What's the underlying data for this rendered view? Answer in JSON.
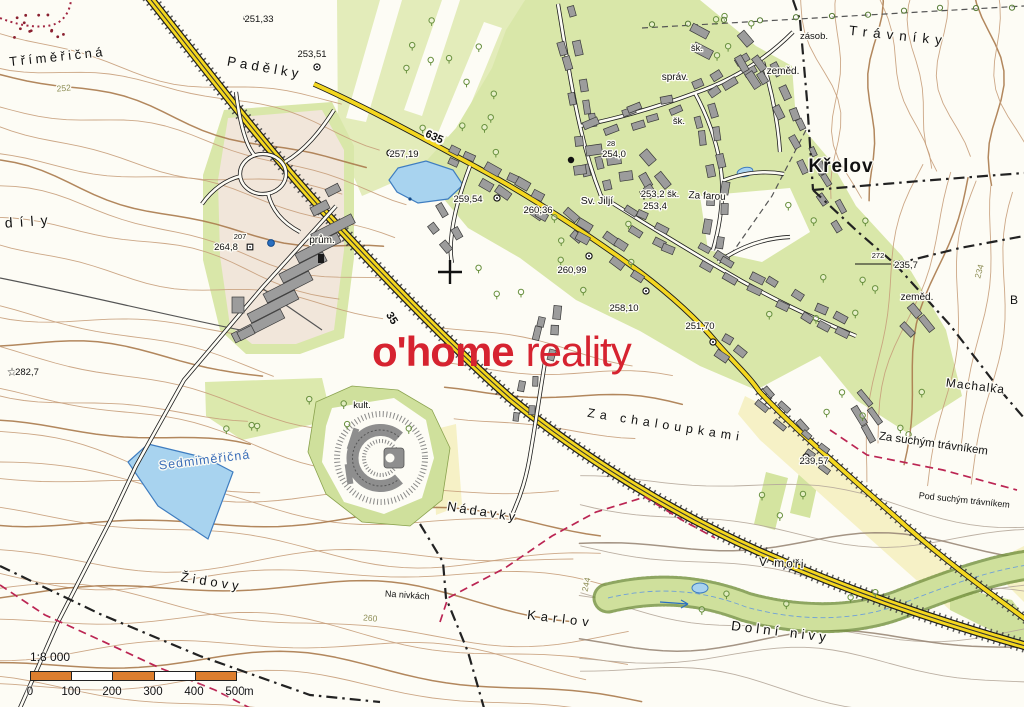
{
  "brand": {
    "part1": "o'home",
    "part2": "reality",
    "color": "#d62330"
  },
  "scale_bar": {
    "ratio": "1:8 000",
    "tick_labels": [
      "0",
      "100",
      "200",
      "300",
      "400",
      "500"
    ],
    "unit": "m",
    "bar_color": "#dd7e2e",
    "segment_count": 5
  },
  "road_labels": [
    {
      "text": "635",
      "x": 433,
      "y": 140,
      "rot": 24
    },
    {
      "text": "35",
      "x": 389,
      "y": 320,
      "rot": 58
    }
  ],
  "contour_labels": [
    {
      "text": "252",
      "x": 64,
      "y": 91,
      "rot": -5
    },
    {
      "text": "260",
      "x": 370,
      "y": 621,
      "rot": 5
    },
    {
      "text": "244",
      "x": 589,
      "y": 585,
      "rot": -78
    },
    {
      "text": "234",
      "x": 982,
      "y": 272,
      "rot": -75
    }
  ],
  "place_labels": [
    {
      "text": "Tříměřičná",
      "x": 58,
      "y": 61,
      "size": 13,
      "rot": -6,
      "ls": 3.5
    },
    {
      "text": "Padělky",
      "x": 264,
      "y": 72,
      "size": 13.5,
      "rot": 10,
      "ls": 4
    },
    {
      "text": "díly",
      "x": 30,
      "y": 226,
      "size": 14,
      "rot": -4,
      "ls": 7
    },
    {
      "text": "Trávníky",
      "x": 898,
      "y": 40,
      "size": 13.5,
      "rot": 6,
      "ls": 6
    },
    {
      "text": "Křelov",
      "x": 841,
      "y": 172,
      "size": 19,
      "rot": 0,
      "ls": 1,
      "bold": true
    },
    {
      "text": "zásob.",
      "x": 814,
      "y": 39,
      "size": 9.5
    },
    {
      "text": "zeměd.",
      "x": 783,
      "y": 74,
      "size": 10
    },
    {
      "text": "zeměd.",
      "x": 917,
      "y": 300,
      "size": 10
    },
    {
      "text": "šk.",
      "x": 697,
      "y": 51,
      "size": 9.5
    },
    {
      "text": "šk.",
      "x": 679,
      "y": 124,
      "size": 9.5
    },
    {
      "text": "správ.",
      "x": 675,
      "y": 80,
      "size": 10
    },
    {
      "text": "Sv. Jiljí",
      "x": 597,
      "y": 204,
      "size": 10.5
    },
    {
      "text": "Za farou",
      "x": 707,
      "y": 199,
      "size": 10,
      "rot": 3
    },
    {
      "text": "prům.",
      "x": 322,
      "y": 243,
      "size": 10
    },
    {
      "text": "kult.",
      "x": 362,
      "y": 408,
      "size": 9.5
    },
    {
      "text": "Sedmiměřičná",
      "x": 205,
      "y": 464,
      "size": 12.5,
      "rot": -7,
      "ls": 1,
      "color": "#3a6db8"
    },
    {
      "text": "Židovy",
      "x": 211,
      "y": 586,
      "size": 13,
      "rot": 9,
      "ls": 4
    },
    {
      "text": "Nádavky",
      "x": 482,
      "y": 516,
      "size": 13,
      "rot": 9,
      "ls": 3
    },
    {
      "text": "Na nivkách",
      "x": 407,
      "y": 598,
      "size": 9,
      "rot": 4
    },
    {
      "text": "Karlov",
      "x": 560,
      "y": 623,
      "size": 13,
      "rot": 7,
      "ls": 5
    },
    {
      "text": "Dolní nivy",
      "x": 780,
      "y": 636,
      "size": 13.5,
      "rot": 7,
      "ls": 4
    },
    {
      "text": "V moři",
      "x": 782,
      "y": 567,
      "size": 12,
      "rot": 3,
      "ls": 2
    },
    {
      "text": "Za chaloupkami",
      "x": 665,
      "y": 429,
      "size": 12.5,
      "rot": 9,
      "ls": 5
    },
    {
      "text": "Machalka",
      "x": 975,
      "y": 390,
      "size": 12,
      "rot": 7,
      "ls": 1
    },
    {
      "text": "Za suchým trávníkem",
      "x": 933,
      "y": 447,
      "size": 11.5,
      "rot": 8
    },
    {
      "text": "Pod suchým trávníkem",
      "x": 964,
      "y": 503,
      "size": 9,
      "rot": 6
    },
    {
      "text": "B",
      "x": 1014,
      "y": 304,
      "size": 12
    }
  ],
  "spot_heights": [
    {
      "value": "251,33",
      "x": 259,
      "y": 22,
      "sym": "circle",
      "sx": 247,
      "sy": 18
    },
    {
      "value": "253,51",
      "x": 312,
      "y": 57,
      "sym": "circle",
      "sx": 317,
      "sy": 67
    },
    {
      "value": "257,19",
      "x": 404,
      "y": 157,
      "sym": "circle",
      "sx": 390,
      "sy": 153
    },
    {
      "value": "259,54",
      "x": 468,
      "y": 202,
      "sym": "circle",
      "sx": 497,
      "sy": 198
    },
    {
      "value": "260,36",
      "x": 538,
      "y": 213
    },
    {
      "value": "254,0",
      "x": 614,
      "y": 157,
      "num": "28",
      "nx": 611,
      "ny": 146
    },
    {
      "value": "253,2 šk.",
      "x": 660,
      "y": 197,
      "sym": "triangle",
      "sx": 644,
      "sy": 195
    },
    {
      "value": "253,4",
      "x": 655,
      "y": 209
    },
    {
      "value": "260,99",
      "x": 572,
      "y": 273,
      "sym": "circle",
      "sx": 589,
      "sy": 256
    },
    {
      "value": "258,10",
      "x": 624,
      "y": 311,
      "sym": "circle",
      "sx": 646,
      "sy": 291
    },
    {
      "value": "251,70",
      "x": 700,
      "y": 329,
      "sym": "circle",
      "sx": 713,
      "sy": 342
    },
    {
      "value": "235,7",
      "x": 906,
      "y": 268,
      "sym": "square",
      "sx": 897,
      "sy": 264,
      "num": "272",
      "nx": 878,
      "ny": 258,
      "sightline": true
    },
    {
      "value": "264,8",
      "x": 226,
      "y": 250,
      "sym": "square",
      "sx": 250,
      "sy": 247,
      "num": "207",
      "nx": 240,
      "ny": 239
    },
    {
      "value": "239,57",
      "x": 814,
      "y": 464,
      "sym": "circle",
      "sx": 806,
      "sy": 457
    },
    {
      "value": "282,7",
      "x": 27,
      "y": 375,
      "sym": "star",
      "sx": 12,
      "sy": 372
    }
  ]
}
